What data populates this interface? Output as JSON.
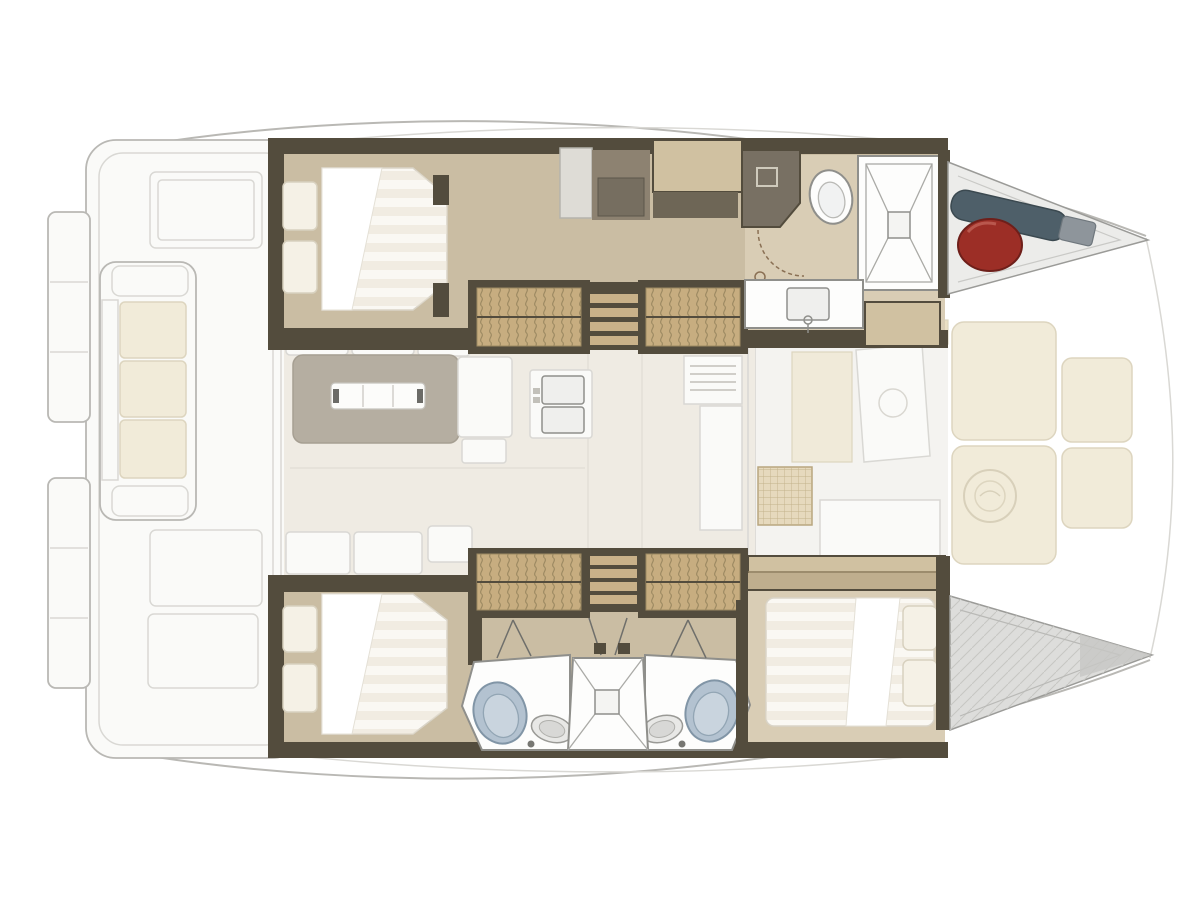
{
  "figure": {
    "title": "Catamaran interior layout floor plan",
    "view": "top-down",
    "bow_direction": "right",
    "drawing_style": "architectural yacht layout, hull interiors in full color, decks ghosted"
  },
  "colors": {
    "bg": "#ffffff",
    "ghost_line": "#b9b8b4",
    "ghost_line_soft": "#d9d8d4",
    "ghost_fill": "#fafaf8",
    "cream": "#f1ebd9",
    "cream_strip": "#eadfc4",
    "cream_line": "#ddd5bf",
    "saloon_floor": "#efebe3",
    "floor_line": "#e3e0d8",
    "table_grey": "#b5aea1",
    "table_edge": "#a69f92",
    "white_obj": "#fcfcfa",
    "wall_dark": "#534c3d",
    "wood_floor": "#cabda3",
    "wood_light": "#d9cdb5",
    "wood_cabinet": "#d0c1a1",
    "olive_cabinet": "#6e6656",
    "grey_cabinet": "#787063",
    "grey_panel": "#dedcd6",
    "brown_cabinet": "#8d8271",
    "steps_wicker": "#c7ad80",
    "steps_line": "#9d8a62",
    "slat_tan": "#c9b189",
    "fixture_white": "#fdfdfc",
    "fixture_line": "#8f8f8b",
    "basin_grey": "#efefed",
    "mattress": "#faf8f3",
    "mattress_stripe": "#e8e1d3",
    "pillow": "#f5f1e6",
    "pillow_line": "#d8d1bf",
    "duvet": "#ffffff",
    "toilet_blue": "#b3c2d0",
    "toilet_line": "#8195a6",
    "fender": "#9c2e26",
    "fender_dark": "#6e1f1a",
    "bag_teal": "#4e5f69",
    "bag_dark": "#3b4950",
    "bag_grey": "#8e959b",
    "bow_grey": "#dddddb",
    "bow_line": "#9b9b98",
    "forepeak": "#ececea",
    "hatch_tan": "#e6d9bd",
    "hatch_line": "#b8a67f"
  },
  "areas": {
    "aft_deck": {
      "name": "aft cockpit and swim platforms",
      "items": [
        "swim-platform-port",
        "swim-platform-starboard",
        "stern-locker-aft",
        "stern-locker-fwd-1",
        "stern-locker-fwd-2",
        "cockpit-sofa"
      ],
      "sofa_cushions": 3
    },
    "port_hull": {
      "name": "port hull (top)",
      "rooms": [
        {
          "name": "aft-cabin",
          "items": [
            "double-bed",
            "pillow",
            "pillow",
            "duvet"
          ]
        },
        {
          "name": "companionway-steps-aft"
        },
        {
          "name": "dressing-area",
          "items": [
            "locker",
            "cabinet",
            "overhead-locker",
            "wardrobe"
          ]
        },
        {
          "name": "companionway-steps-forward"
        },
        {
          "name": "bathroom",
          "items": [
            "toilet",
            "shower",
            "washbasin",
            "vanity",
            "door-swing"
          ]
        },
        {
          "name": "forepeak-locker",
          "items": [
            "fender",
            "sail-bag"
          ]
        }
      ]
    },
    "starboard_hull": {
      "name": "starboard hull (bottom)",
      "rooms": [
        {
          "name": "aft-cabin",
          "items": [
            "double-bed",
            "pillow",
            "pillow",
            "duvet"
          ]
        },
        {
          "name": "companionway-steps-aft"
        },
        {
          "name": "bathroom-aft",
          "items": [
            "toilet",
            "washbasin"
          ]
        },
        {
          "name": "shared-shower",
          "items": [
            "shower-tray",
            "drain",
            "hinged-doors"
          ]
        },
        {
          "name": "bathroom-forward",
          "items": [
            "toilet",
            "washbasin"
          ]
        },
        {
          "name": "companionway-steps-forward"
        },
        {
          "name": "forward-cabin",
          "items": [
            "double-bed",
            "pillow",
            "pillow",
            "duvet",
            "head-cabinet"
          ]
        },
        {
          "name": "bow-storage"
        }
      ]
    },
    "saloon": {
      "name": "saloon and galley",
      "items": [
        "dining-table",
        "table-leaf",
        "sofa-cushions-top",
        "sofa-cushions-bottom",
        "galley-counter",
        "double-sink",
        "stove",
        "forward-counter",
        "forward-door"
      ]
    },
    "foredeck": {
      "name": "foredeck lounge",
      "items": [
        "side-cushion-strip-port",
        "side-cushion-strip-starboard",
        "forward-cockpit-door",
        "deck-hatch",
        "sunpad",
        "sunpad",
        "sunpad",
        "sunpad",
        "builder-medallion"
      ]
    }
  }
}
